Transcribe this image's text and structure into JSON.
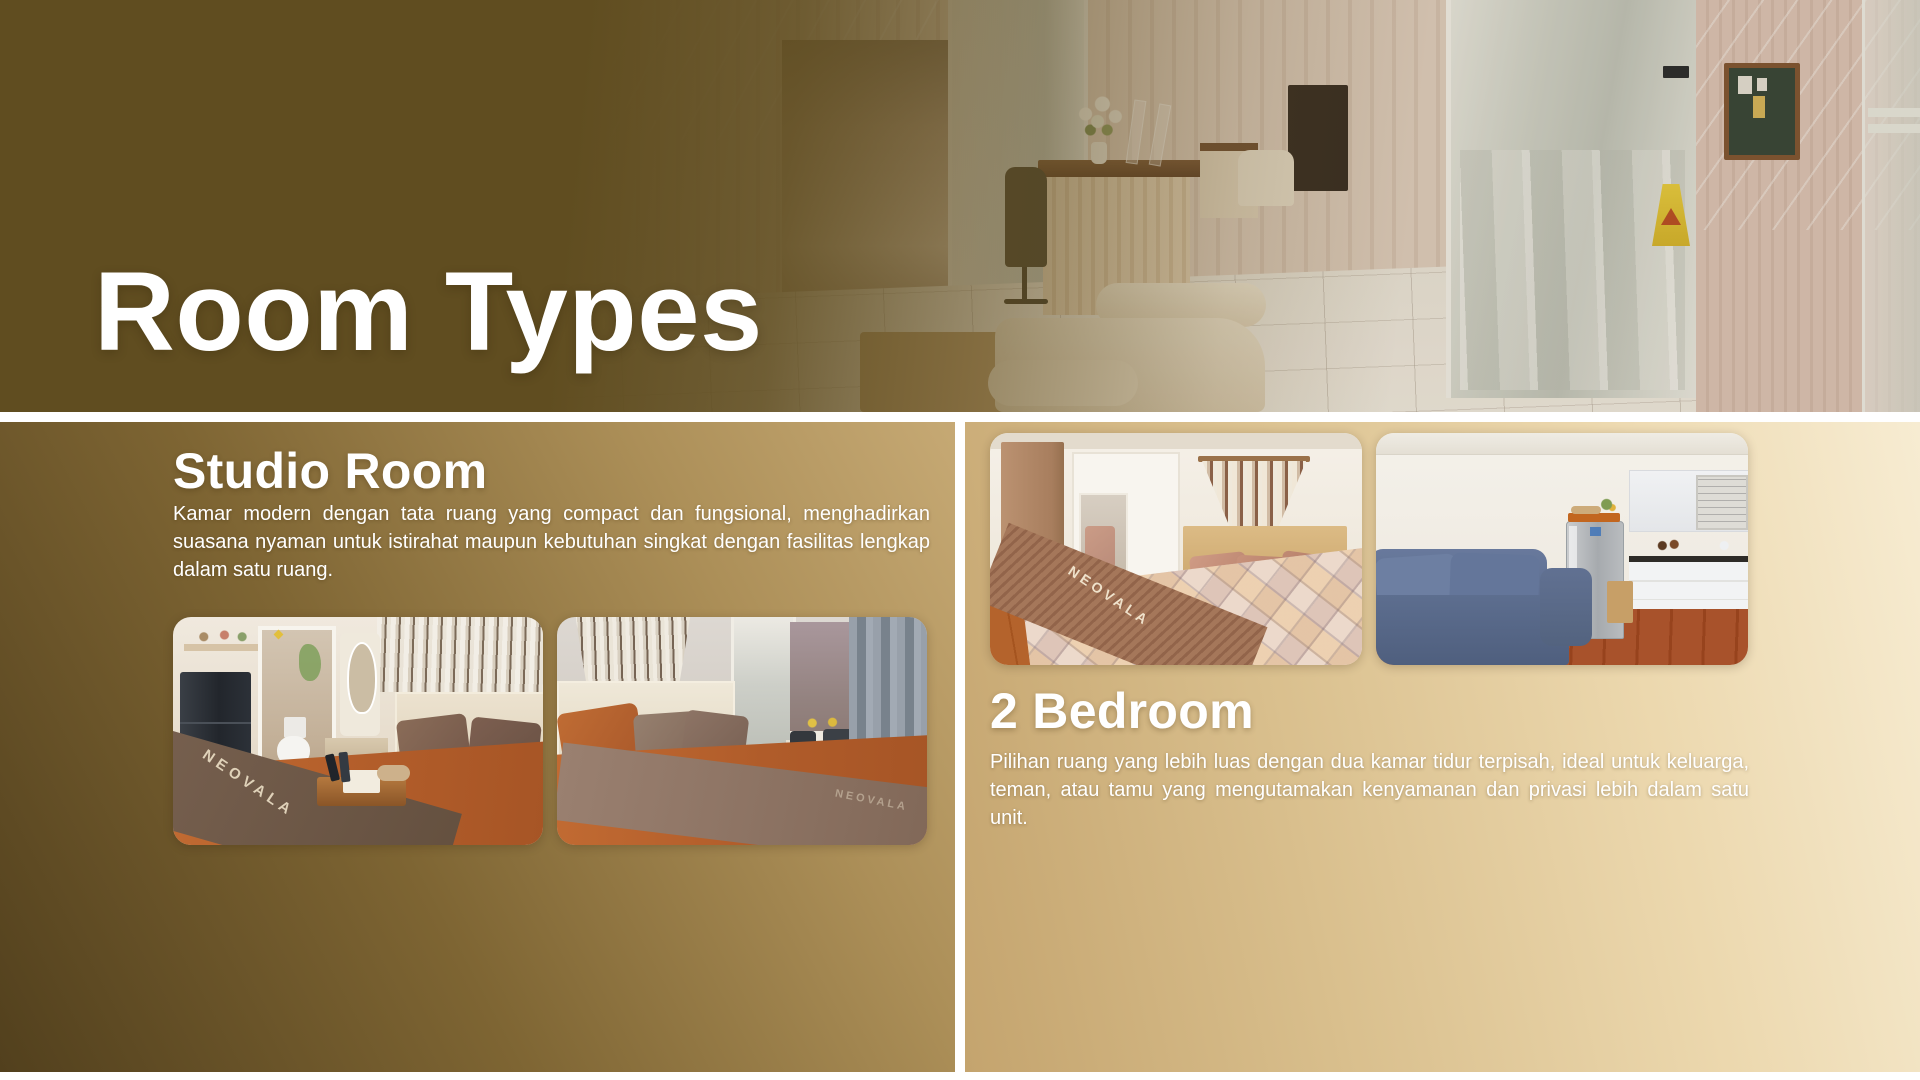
{
  "hero": {
    "title": "Room Types"
  },
  "sections": [
    {
      "id": "studio",
      "heading": "Studio Room",
      "body": "Kamar modern dengan tata ruang yang compact dan fungsional, menghadirkan suasana nyaman untuk istirahat maupun kebutuhan singkat dengan fasilitas lengkap dalam satu ruang.",
      "photos": [
        {
          "name": "studio-bedroom-with-fridge-and-bathroom",
          "watermark": "NEOVALA"
        },
        {
          "name": "studio-bedroom-with-window-and-curtain",
          "watermark": "NEOVALA"
        }
      ]
    },
    {
      "id": "2-bedroom",
      "heading": "2 Bedroom",
      "body": "Pilihan ruang yang lebih luas dengan dua kamar tidur terpisah, ideal untuk keluarga, teman, atau tamu yang mengutamakan kenyamanan dan privasi lebih dalam satu unit.",
      "photos": [
        {
          "name": "bedroom-with-patterned-bedding",
          "watermark": "NEOVALA"
        },
        {
          "name": "living-room-kitchen-with-blue-sofa",
          "watermark": ""
        }
      ]
    }
  ],
  "colors": {
    "brand_brown": "#604d20",
    "panel_tan": "#c6a974",
    "panel_cream": "#f7ecd2",
    "text": "#ffffff"
  }
}
